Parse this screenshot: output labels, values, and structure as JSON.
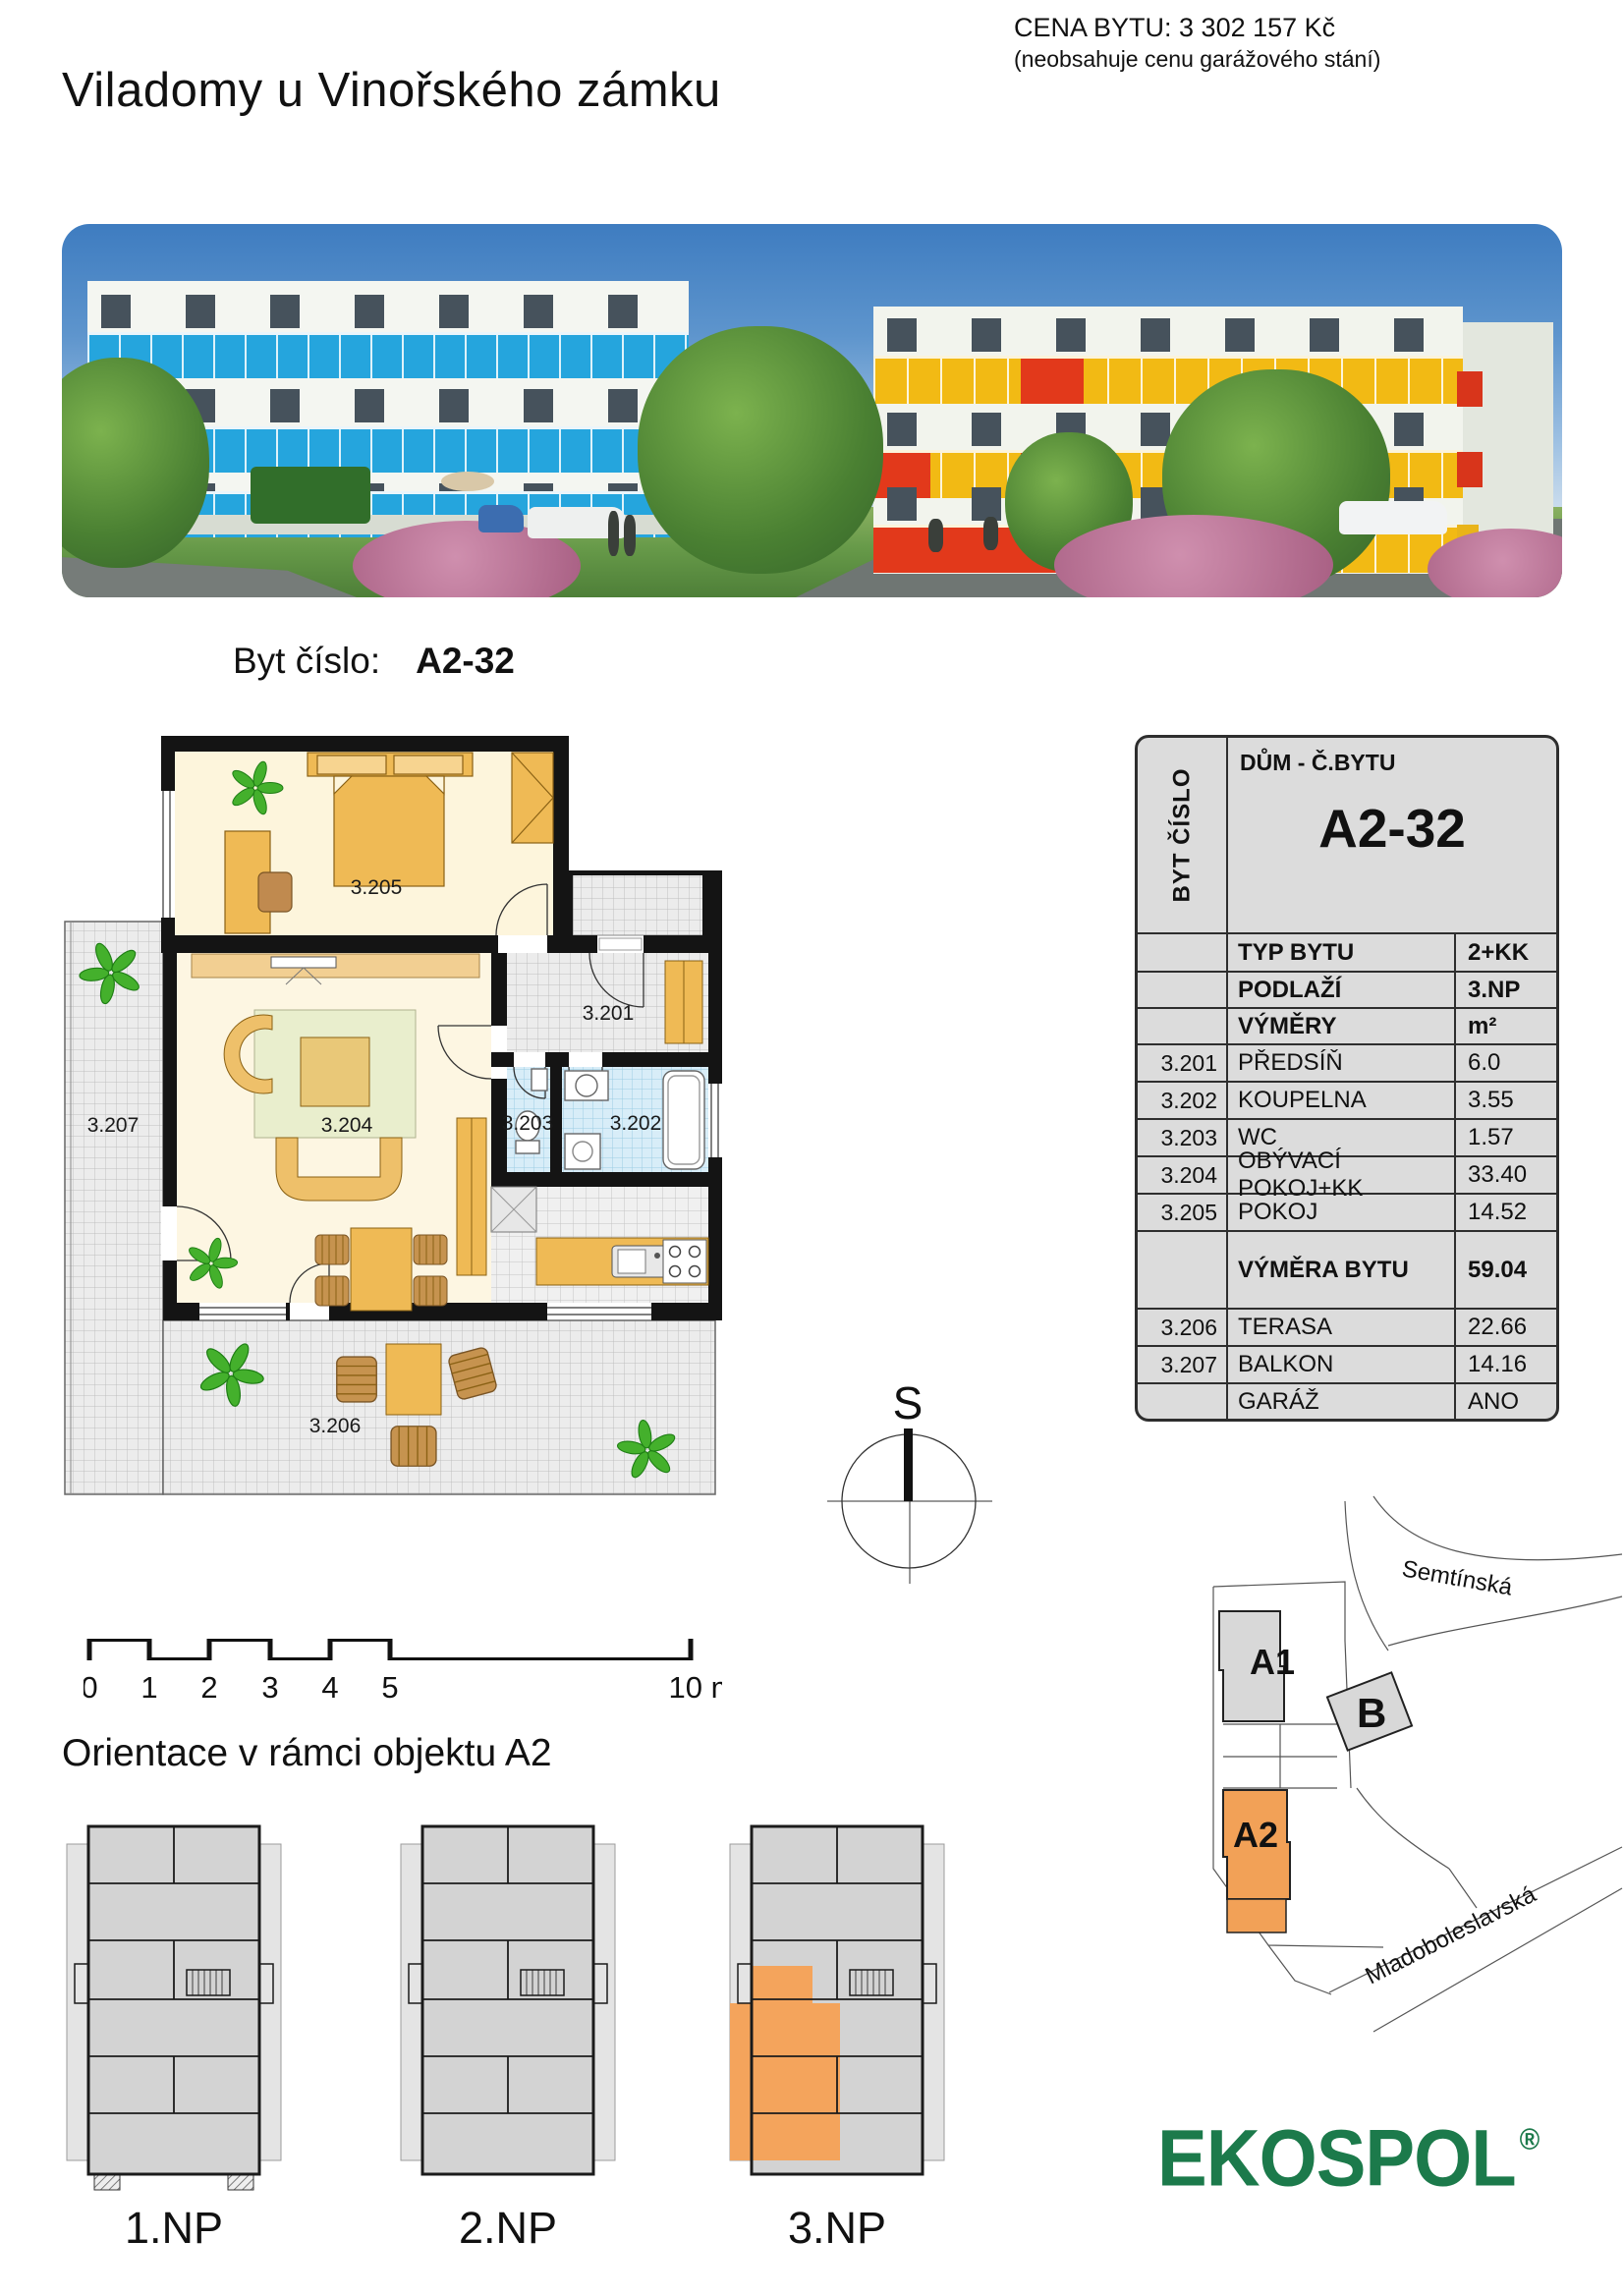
{
  "header": {
    "price_label": "CENA BYTU: 3 302 157 Kč",
    "price_note": "(neobsahuje cenu garážového stání)",
    "title": "Viladomy u Vinořského zámku"
  },
  "apartment": {
    "byt_label": "Byt číslo:",
    "byt_value": "A2-32"
  },
  "floorplan": {
    "rooms": {
      "r201": "3.201",
      "r202": "3.202",
      "r203": "3.203",
      "r204": "3.204",
      "r205": "3.205",
      "r206": "3.206",
      "r207": "3.207"
    }
  },
  "compass": {
    "north_label": "S"
  },
  "scalebar": {
    "ticks": [
      "0",
      "1",
      "2",
      "3",
      "4",
      "5"
    ],
    "end_label": "10 m"
  },
  "info_table": {
    "side_label": "BYT ČÍSLO",
    "header_label": "DŮM - Č.BYTU",
    "header_value": "A2-32",
    "meta": [
      {
        "label": "TYP BYTU",
        "value": "2+KK"
      },
      {
        "label": "PODLAŽÍ",
        "value": "3.NP"
      },
      {
        "label": "VÝMĚRY",
        "value": "m²"
      }
    ],
    "rooms": [
      {
        "num": "3.201",
        "name": "PŘEDSÍŇ",
        "area": "6.0"
      },
      {
        "num": "3.202",
        "name": "KOUPELNA",
        "area": "3.55"
      },
      {
        "num": "3.203",
        "name": "WC",
        "area": "1.57"
      },
      {
        "num": "3.204",
        "name": "OBÝVACÍ POKOJ+KK",
        "area": "33.40"
      },
      {
        "num": "3.205",
        "name": "POKOJ",
        "area": "14.52"
      }
    ],
    "total": {
      "label": "VÝMĚRA BYTU",
      "value": "59.04"
    },
    "extras": [
      {
        "num": "3.206",
        "name": "TERASA",
        "area": "22.66"
      },
      {
        "num": "3.207",
        "name": "BALKON",
        "area": "14.16"
      },
      {
        "num": "",
        "name": "GARÁŽ",
        "area": "ANO"
      }
    ]
  },
  "orientation": {
    "heading": "Orientace v rámci objektu A2",
    "floors": [
      "1.NP",
      "2.NP",
      "3.NP"
    ]
  },
  "sitemap": {
    "buildings": [
      "A1",
      "B",
      "A2"
    ],
    "streets": [
      "Semtínská",
      "Mladoboleslavská"
    ]
  },
  "logo": {
    "text": "EKOSPOL",
    "reg": "®"
  },
  "colors": {
    "highlight_orange": "#f2a157",
    "table_grey": "#dcdcdc",
    "logo_green": "#1c7a4b",
    "balcony_blue": "#25a5dd",
    "balcony_yellow": "#f2ba14",
    "balcony_red": "#e2391b"
  }
}
